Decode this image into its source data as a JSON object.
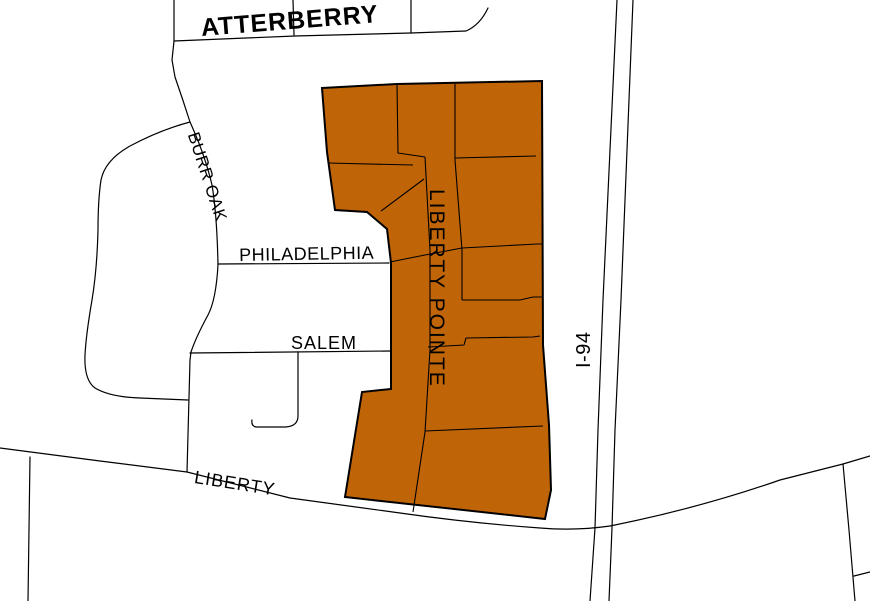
{
  "map": {
    "labels": {
      "atterberry": "ATTERBERRY",
      "burr_oak": "BURR OAK",
      "philadelphia": "PHILADELPHIA",
      "salem": "SALEM",
      "liberty": "LIBERTY",
      "i94": "I-94",
      "liberty_pointe": "LIBERTY POINTE"
    },
    "colors": {
      "background": "#FFFFFF",
      "road_line": "#000000",
      "label_text": "#000000",
      "parcel_fill": "#C06408",
      "parcel_outline": "#000000"
    }
  }
}
